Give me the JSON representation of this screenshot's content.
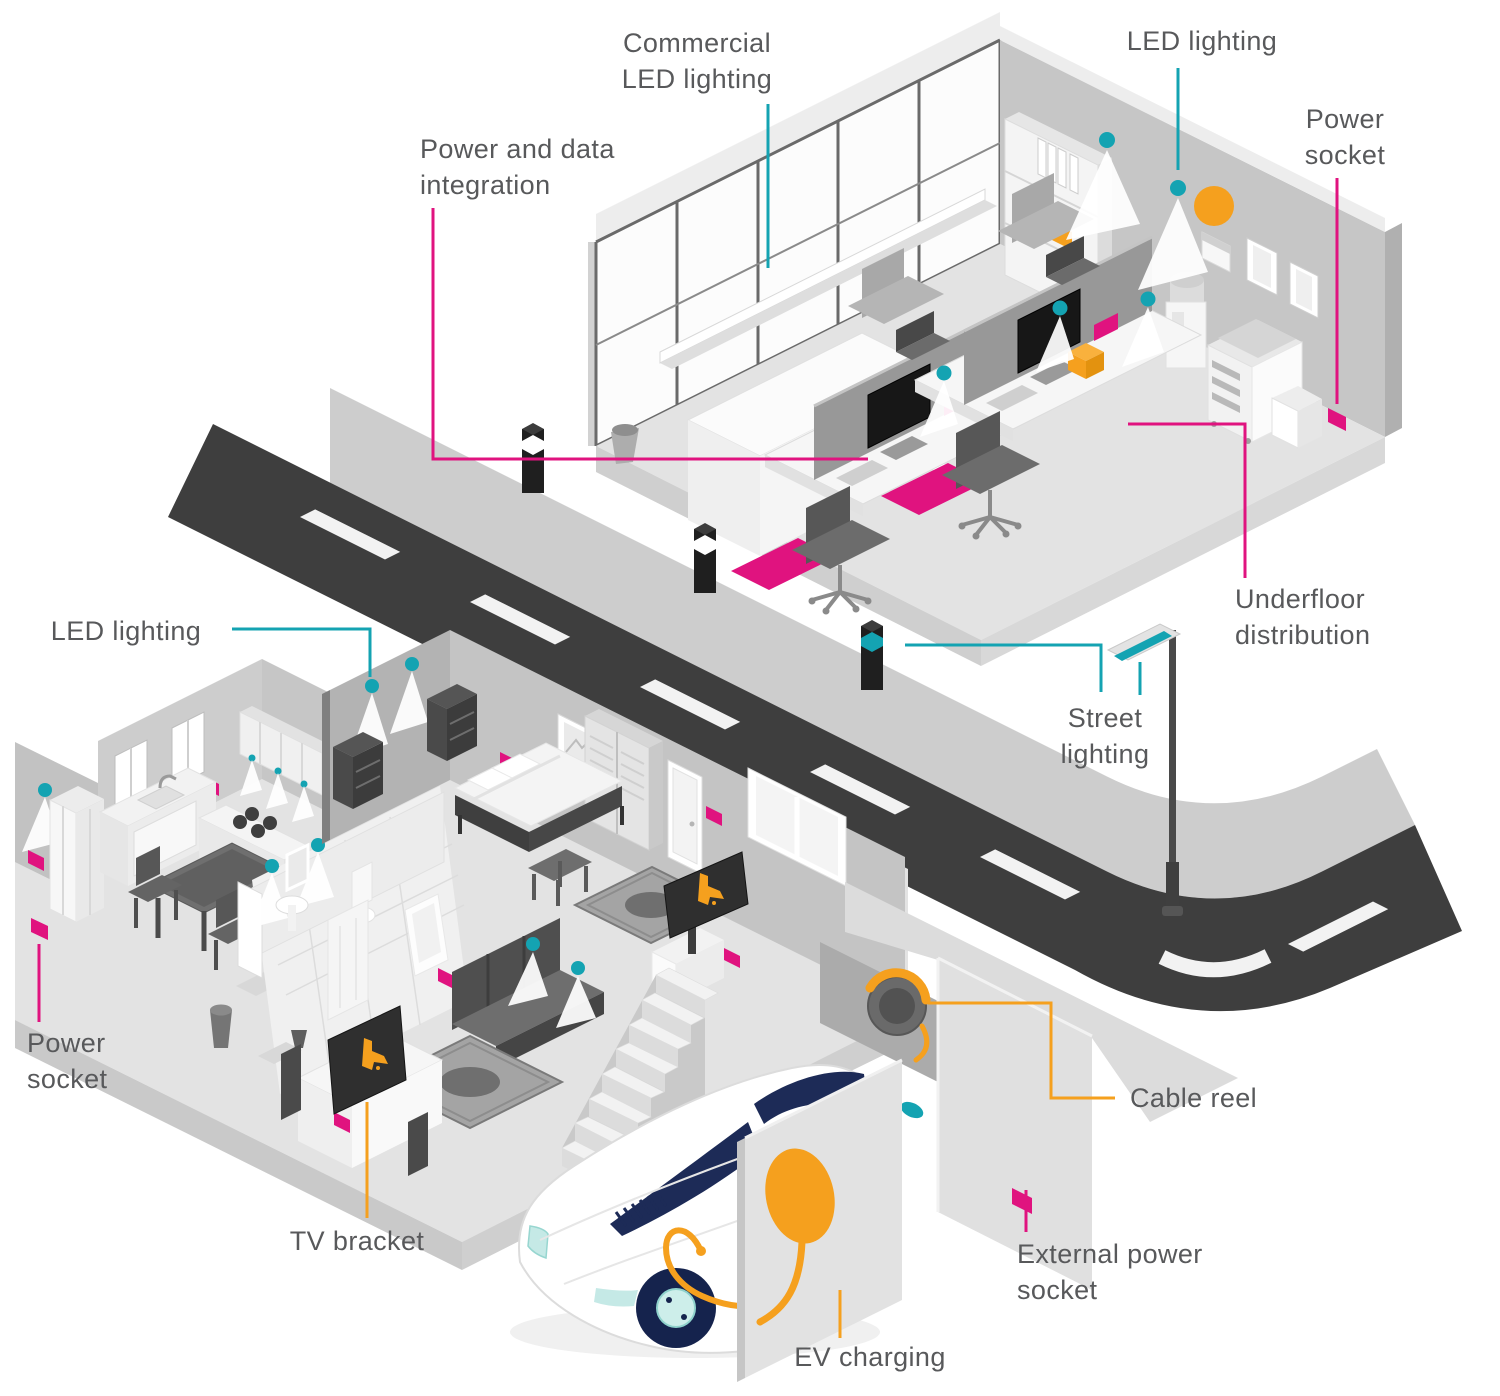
{
  "colors": {
    "teal": "#14a3b2",
    "magenta": "#e0137f",
    "orange": "#f5a01e",
    "label_text": "#58595b",
    "road": "#3e3e3e",
    "pavement": "#cdcdcd",
    "navy": "#1d2b57"
  },
  "labels": {
    "commercial_led_lighting": {
      "line1": "Commercial",
      "line2": "LED lighting",
      "color": "teal"
    },
    "power_and_data_integration": {
      "line1": "Power and data",
      "line2": "integration",
      "color": "magenta"
    },
    "led_lighting_office": {
      "line1": "LED lighting",
      "color": "teal"
    },
    "power_socket_office": {
      "line1": "Power",
      "line2": "socket",
      "color": "magenta"
    },
    "underfloor_distribution": {
      "line1": "Underfloor",
      "line2": "distribution",
      "color": "magenta"
    },
    "street_lighting": {
      "line1": "Street",
      "line2": "lighting",
      "color": "teal"
    },
    "led_lighting_house": {
      "line1": "LED lighting",
      "color": "teal"
    },
    "power_socket_house": {
      "line1": "Power",
      "line2": "socket",
      "color": "magenta"
    },
    "tv_bracket": {
      "line1": "TV bracket",
      "color": "orange"
    },
    "cable_reel": {
      "line1": "Cable reel",
      "color": "orange"
    },
    "external_power_socket": {
      "line1": "External power",
      "line2": "socket",
      "color": "magenta"
    },
    "ev_charging": {
      "line1": "EV charging",
      "color": "orange"
    }
  },
  "icons": {
    "downlight": "teal dot with white light cone",
    "power_socket": "magenta wall socket",
    "underfloor_pad": "magenta floor distribution pad",
    "led_strip": "white linear LED ledge on office glazing",
    "smart_bollard": "black bollard with banded collar",
    "street_light": "lamp post with teal underside head",
    "cable_reel": "orange cable coil on garage wall",
    "ev_charger": "orange wall charger with cable to car",
    "tv_bracket": "orange bracket glyph on TV screen"
  }
}
